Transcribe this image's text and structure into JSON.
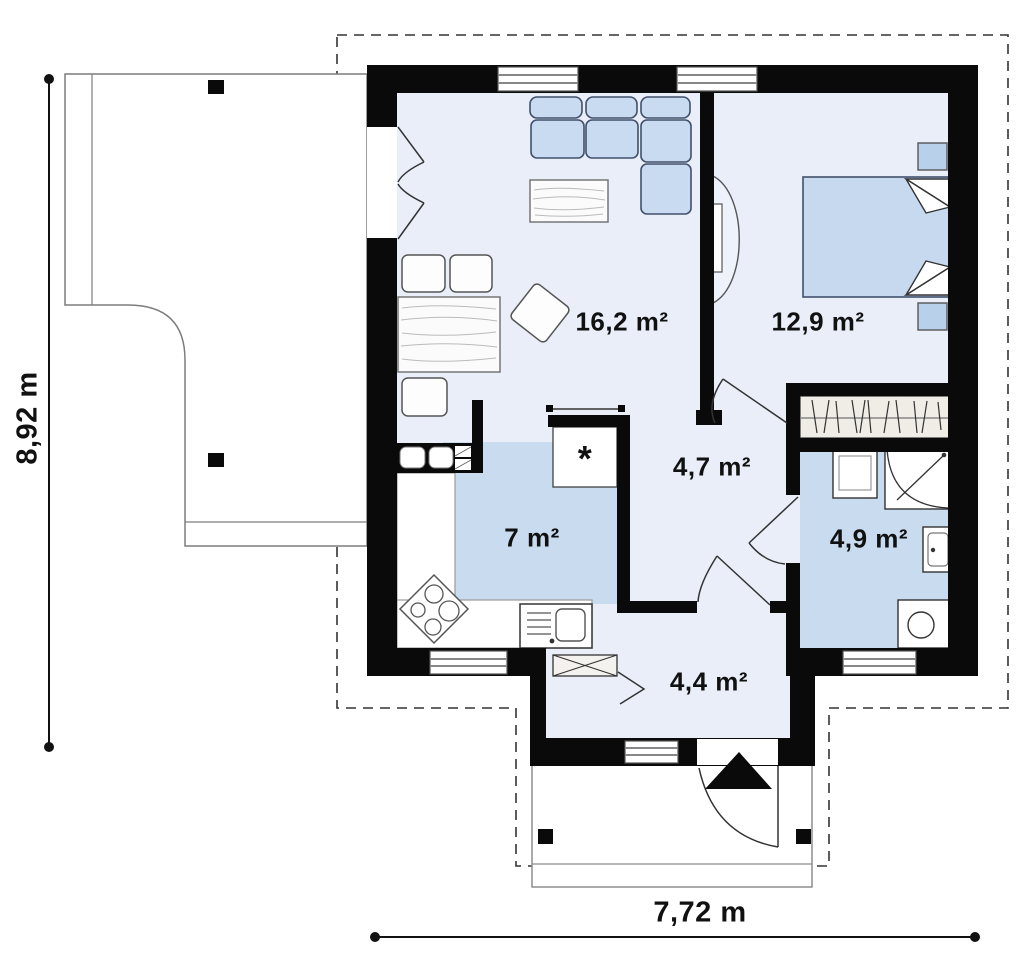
{
  "plan_title": "house floor plan",
  "rooms": {
    "living": {
      "area": "16,2 m²"
    },
    "bedroom": {
      "area": "12,9 m²"
    },
    "hallway": {
      "area": "4,7 m²"
    },
    "kitchen": {
      "area": "7 m²"
    },
    "bathroom": {
      "area": "4,9 m²"
    },
    "entry": {
      "area": "4,4 m²"
    }
  },
  "dimensions": {
    "vertical": "8,92 m",
    "horizontal": "7,72 m"
  },
  "markers": {
    "fridge": "*"
  },
  "colors": {
    "wall": "#0a0a0a",
    "floor_light": "#e9eef8",
    "floor_dark": "#c9dbef",
    "furniture_blue": "#c9dbf1",
    "outline_dashed": "#333333"
  }
}
